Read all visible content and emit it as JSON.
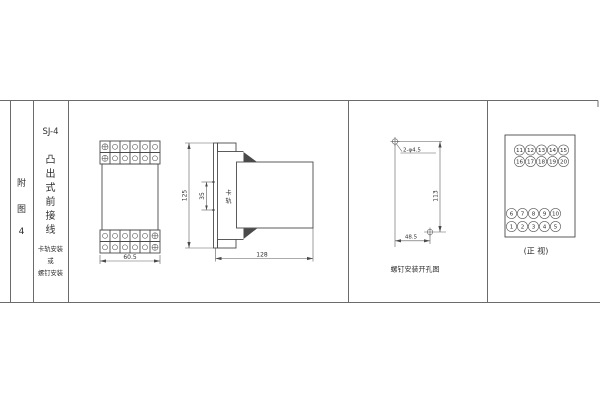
{
  "sheet": {
    "figure_label_chars": [
      "附",
      "图",
      "4"
    ],
    "model": "SJ-4",
    "type_chars": [
      "凸",
      "出",
      "式",
      "前",
      "接",
      "线"
    ],
    "mounting_note_lines": [
      "卡轨安装",
      "或",
      "螺钉安装"
    ]
  },
  "front_view": {
    "width_dim": "60.5"
  },
  "side_view": {
    "height_dim": "125",
    "slot_dim": "35",
    "slot_label_chars": [
      "卡",
      "轨"
    ],
    "length_dim": "128"
  },
  "drill_view": {
    "holes_label": "2-φ4.5",
    "vertical_dim": "113",
    "horizontal_dim": "48.5",
    "caption": "螺钉安装开孔图"
  },
  "terminal_view": {
    "caption": "(正 视)",
    "top_rows": [
      [
        "11",
        "12",
        "13",
        "14",
        "15"
      ],
      [
        "16",
        "17",
        "18",
        "19",
        "20"
      ]
    ],
    "bottom_rows": [
      [
        "6",
        "7",
        "8",
        "9",
        "10"
      ],
      [
        "1",
        "2",
        "3",
        "4",
        "5"
      ]
    ]
  },
  "colors": {
    "line": "#4a4a4a",
    "text": "#2f2f2f",
    "background": "#ffffff"
  }
}
